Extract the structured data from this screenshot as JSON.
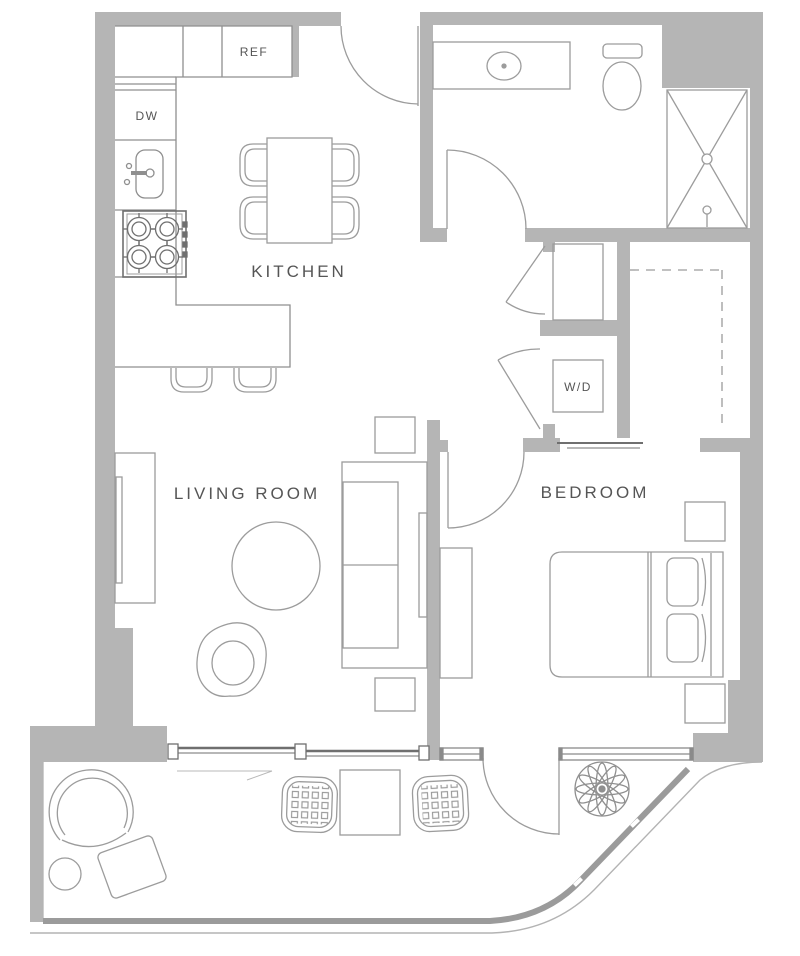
{
  "title": "one-bedroom apartment floor plan",
  "colors": {
    "wall": "#b5b5b5",
    "line": "#9c9c9c",
    "dark_line": "#6f6f6f",
    "light_line": "#b3b3b3",
    "text": "#555555"
  },
  "rooms": {
    "kitchen": {
      "label": "KITCHEN"
    },
    "living_room": {
      "label": "LIVING ROOM"
    },
    "bedroom": {
      "label": "BEDROOM"
    }
  },
  "appliances": {
    "refrigerator": {
      "label": "REF"
    },
    "dishwasher": {
      "label": "DW"
    },
    "washer_dryer": {
      "label": "W/D"
    }
  }
}
